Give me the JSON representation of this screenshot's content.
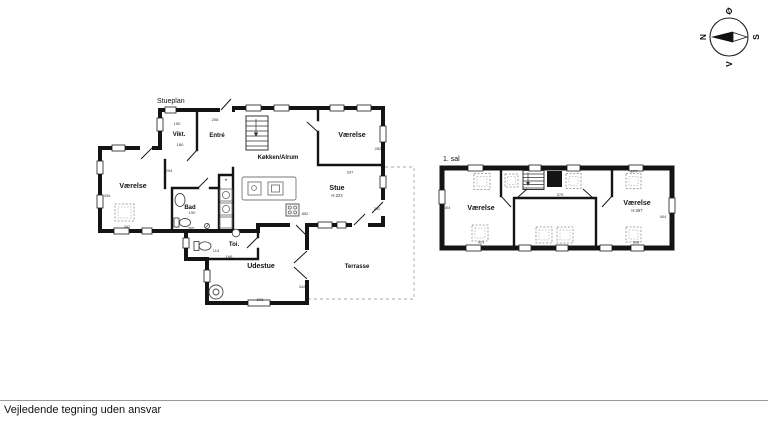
{
  "footer": {
    "disclaimer": "Vejledende tegning uden ansvar"
  },
  "compass": {
    "north": "N",
    "east": "Ø",
    "south": "S",
    "west": "V"
  },
  "ground_floor": {
    "title": "Stueplan",
    "rooms": {
      "vikt": "Vikt.",
      "entre": "Entré",
      "vaerelse_left": "Værelse",
      "bad": "Bad",
      "koekken": "Køkken/Alrum",
      "vaerelse_top": "Værelse",
      "stue": "Stue",
      "stue_height": "H:223",
      "toi": "Toi.",
      "udestue": "Udestue",
      "terrasse": "Terrasse"
    },
    "dims": {
      "vikt_width": "150",
      "vikt_depth": "180",
      "entre_top": "208",
      "vaerelse_left_height": "434",
      "vaerelse_left_door": "204",
      "vaerelse_left_width": "342",
      "bad_depth": "190",
      "bad_width": "305",
      "vaerelse_top_right": "282",
      "stue_top": "337",
      "stue_right": "292",
      "stue_stove": "852",
      "toi_depth": "113",
      "toi_width": "166",
      "udestue_right": "342",
      "udestue_width": "508"
    },
    "symbols": {
      "shaft": "*"
    }
  },
  "first_floor": {
    "title": "1. sal",
    "rooms": {
      "vaerelse_left": "Værelse",
      "vaerelse_right": "Værelse",
      "vaerelse_right_height": "H:267"
    },
    "dims": {
      "left_height": "404",
      "left_width": "423",
      "middle_top": "379",
      "right_top": "277",
      "right_height": "404",
      "right_width": "396"
    }
  }
}
